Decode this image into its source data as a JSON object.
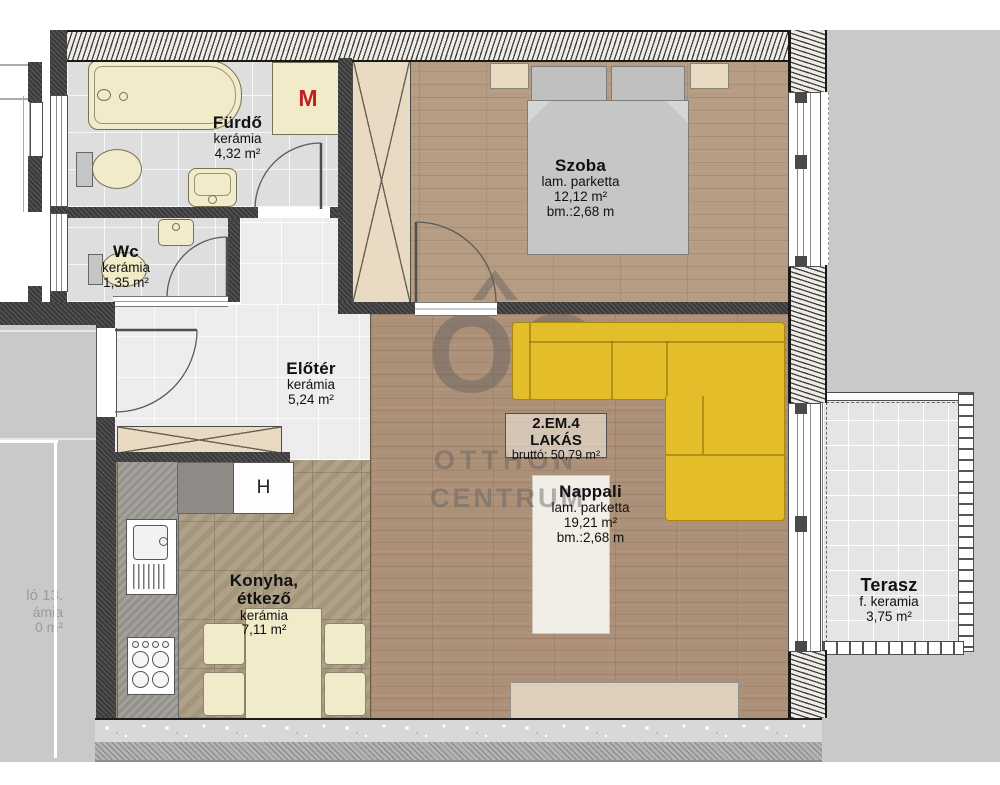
{
  "rooms": {
    "furdo": {
      "name": "Fürdő",
      "floor": "kerámia",
      "area": "4,32 m²"
    },
    "wc": {
      "name": "Wc",
      "floor": "kerámia",
      "area": "1,35 m²"
    },
    "szoba": {
      "name": "Szoba",
      "floor": "lam. parketta",
      "area": "12,12 m²",
      "height": "bm.:2,68 m"
    },
    "eloter": {
      "name": "Előtér",
      "floor": "kerámia",
      "area": "5,24 m²"
    },
    "nappali": {
      "name": "Nappali",
      "floor": "lam. parketta",
      "area": "19,21 m²",
      "height": "bm.:2,68 m"
    },
    "konyha": {
      "name_line1": "Konyha,",
      "name_line2": "étkező",
      "floor": "kerámia",
      "area": "7,11 m²"
    },
    "terasz": {
      "name": "Terasz",
      "floor": "f. keramia",
      "area": "3,75 m²"
    }
  },
  "unit": {
    "line1": "2.EM.4",
    "line2": "LAKÁS",
    "gross": "bruttó: 50,79 m²"
  },
  "appliances": {
    "washing_machine_label": "M",
    "fridge_label": "H"
  },
  "watermark": {
    "logo_text": "OC",
    "brand_line1": "OTTHON",
    "brand_line2": "CENTRUM"
  },
  "neighbor": {
    "clipped_line1": "ló 13.",
    "clipped_line2": "ámia",
    "clipped_line3": "0 m²"
  },
  "colors": {
    "sofa_yellow": "#e3bd2a",
    "cream_fixture": "#f2ebc9",
    "wood_bedroom": "#b69c82",
    "wood_living": "#ac9078",
    "kitchen_tile": "#ab9d82",
    "bathroom_tile": "#dedede",
    "exterior_gray": "#c9c9c9",
    "wall_dark": "#3b3b3b",
    "washing_machine_red": "#c22020",
    "watermark_gray": "#5f5f5f"
  }
}
